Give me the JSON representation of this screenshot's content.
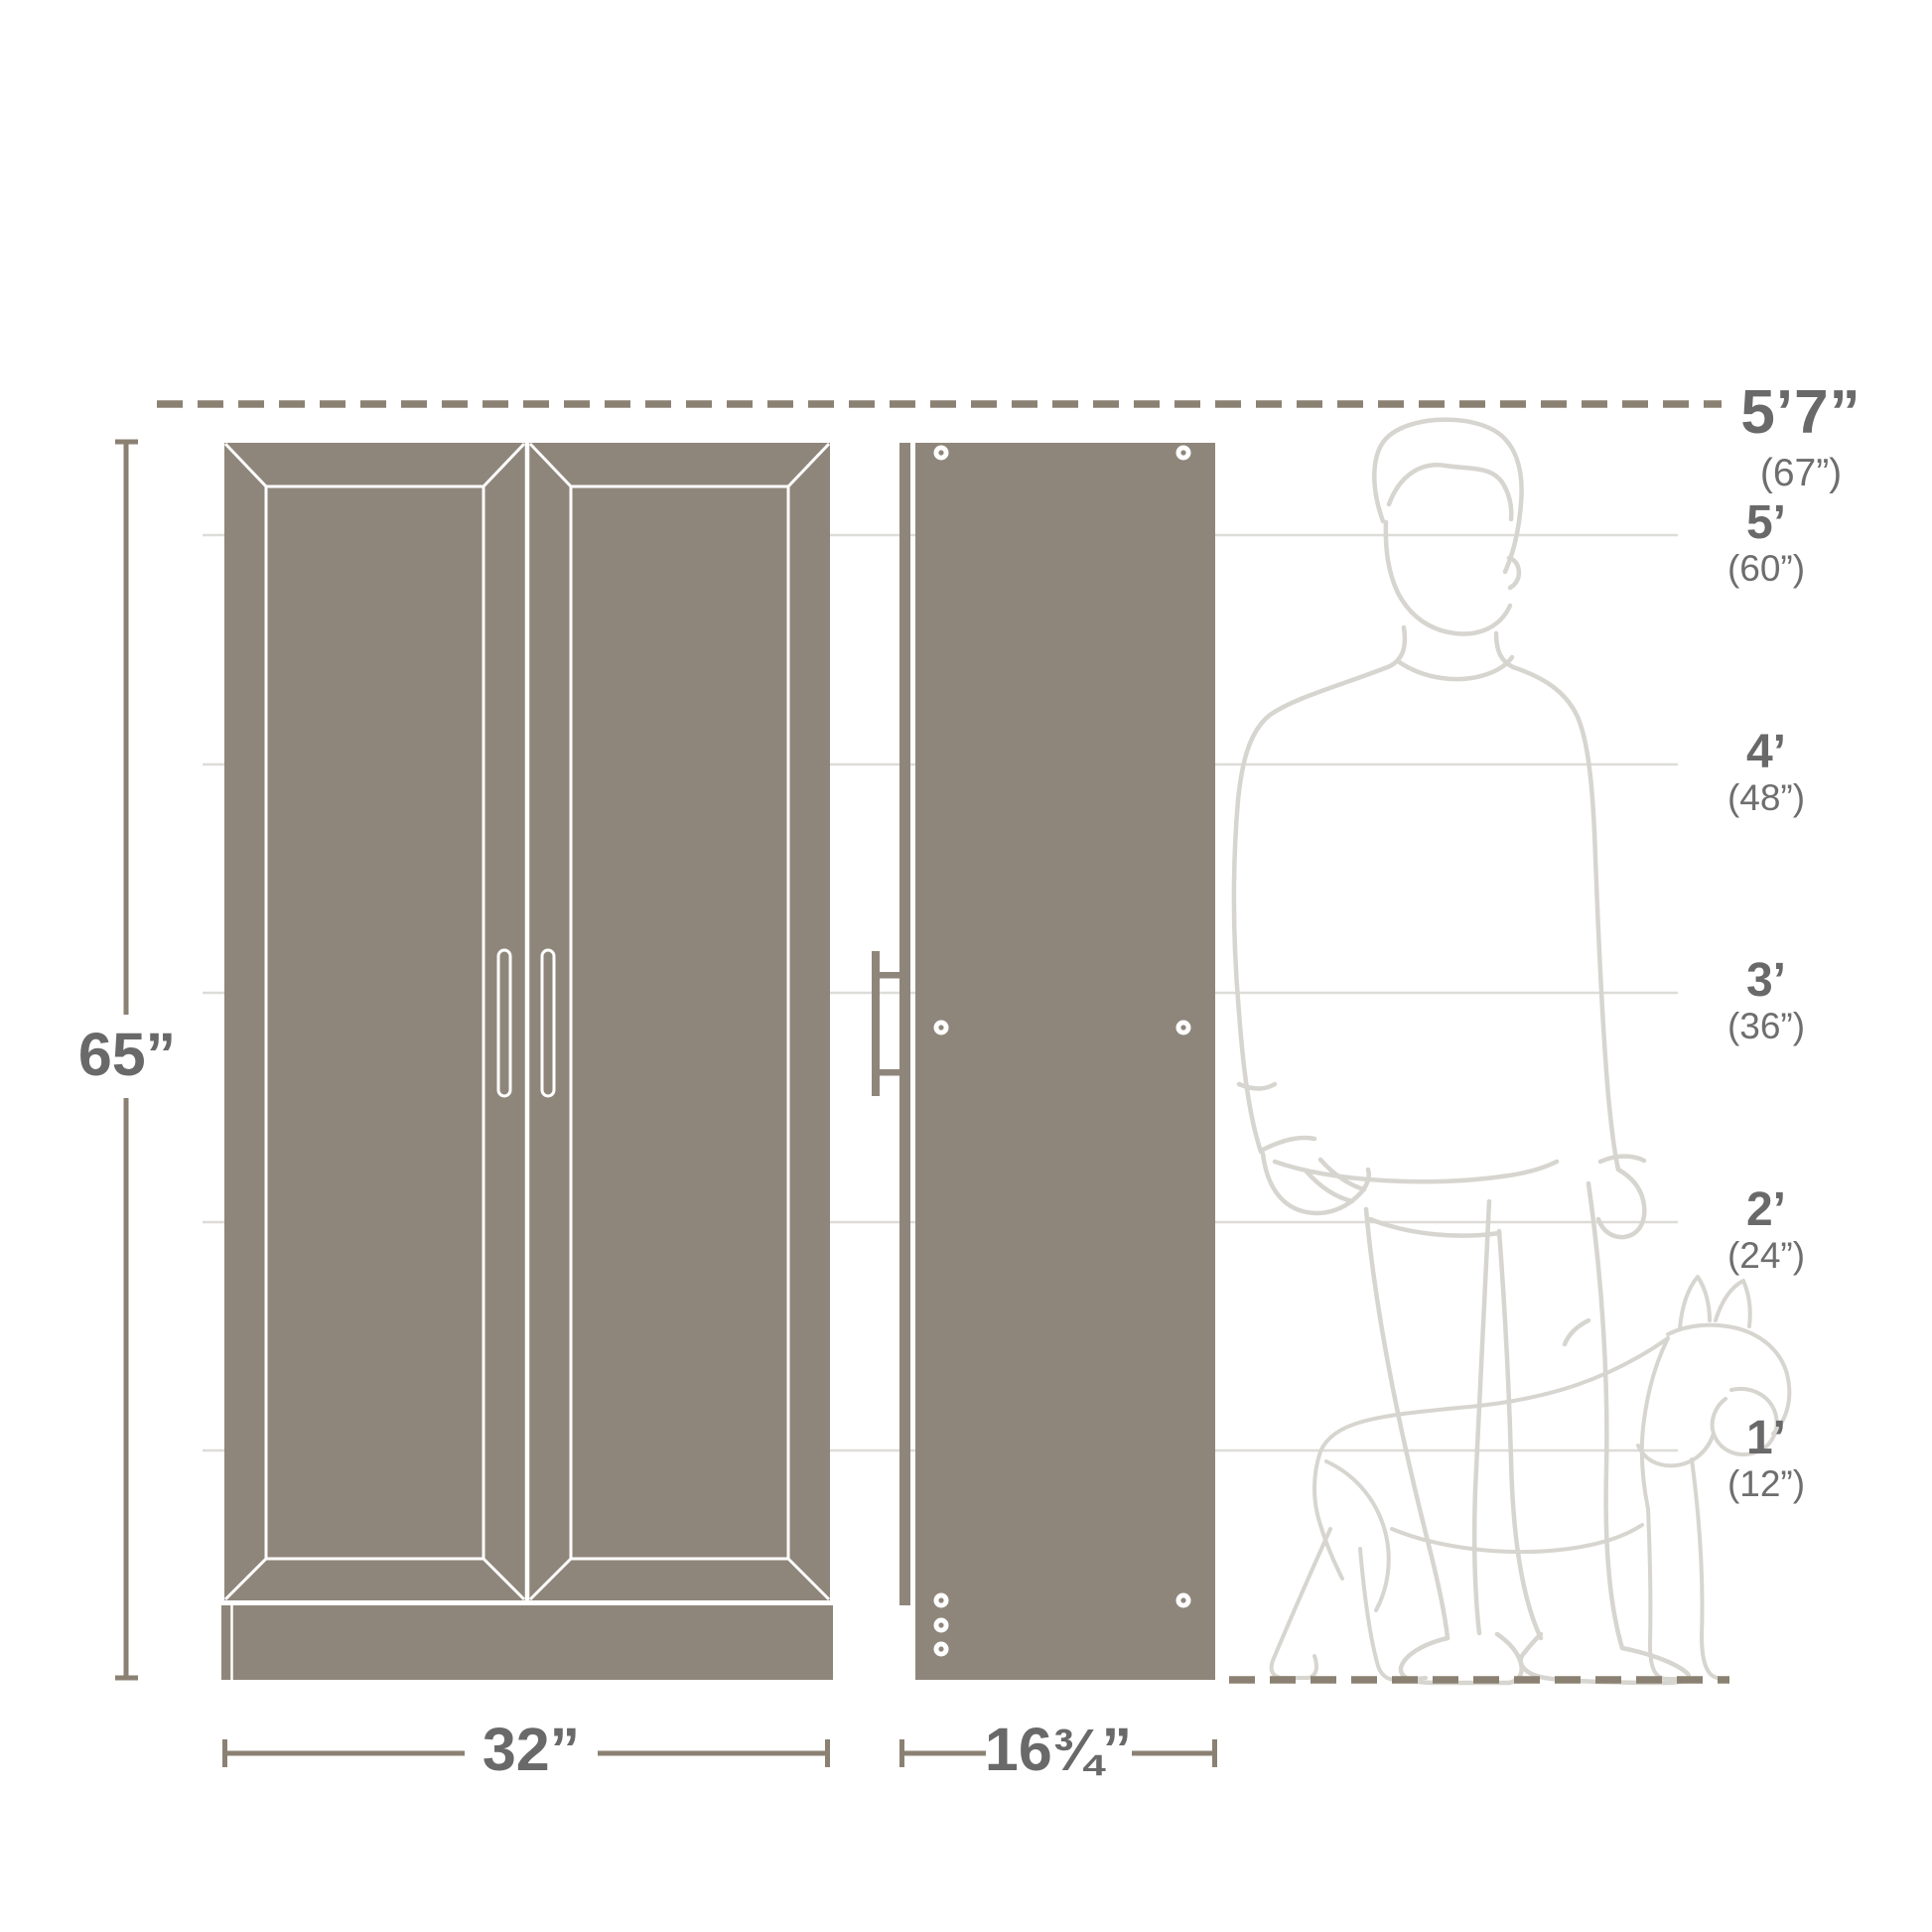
{
  "diagram": {
    "kind": "product-dimensions-diagram",
    "palette": {
      "cabinet_fill": "#8f867b",
      "dimension_line": "#8b8173",
      "grid_line": "#dedcd8",
      "label_text": "#696969",
      "figure_outline": "#d7d5cf",
      "background": "#ffffff"
    }
  },
  "dimension_labels": {
    "height": "65”",
    "front_width": "32”",
    "side_depth_prefix": "16",
    "side_depth_fraction": "¾",
    "side_depth_suffix": "”"
  },
  "height_scale": {
    "top": {
      "feet": "5’7”",
      "inches": "(67”)"
    },
    "marks": [
      {
        "feet": "5’",
        "inches": "(60”)"
      },
      {
        "feet": "4’",
        "inches": "(48”)"
      },
      {
        "feet": "3’",
        "inches": "(36”)"
      },
      {
        "feet": "2’",
        "inches": "(24”)"
      },
      {
        "feet": "1’",
        "inches": "(12”)"
      }
    ]
  },
  "figures": {
    "person": "person-outline-illustration",
    "dog": "french-bulldog-outline-illustration"
  }
}
